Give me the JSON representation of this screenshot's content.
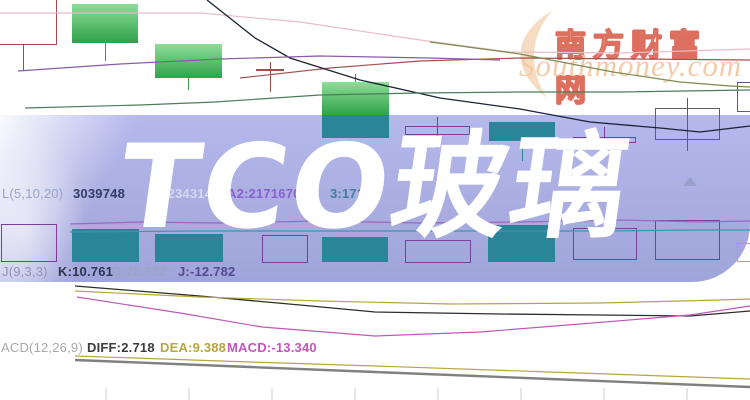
{
  "banner": {
    "title": "TCO玻璃"
  },
  "watermark": {
    "cn": "南方财富网",
    "en": "Southmoney.com"
  },
  "rows": {
    "vol": {
      "label": "L(5,10,20)",
      "value": "3039748",
      "ma1": ":234314",
      "ma2": "A2:2171670",
      "ma3": "3:171"
    },
    "kdj": {
      "label": "J(9,3,3)",
      "k": "K:10.761",
      "d": "D:22.532",
      "j": "J:-12.782"
    },
    "macd": {
      "label": "ACD(12,26,9)",
      "diff": "DIFF:2.718",
      "dea": "DEA:9.388",
      "macd": "MACD:-13.340"
    }
  },
  "colors": {
    "band": "#abafe0",
    "banner_text": "#ffffff",
    "green_candle_top": "#8edd98",
    "green_candle": "#2fa24a",
    "teal": "#2b8598",
    "maroon": "#a34a4a",
    "purple_outline": "#7a3f9a",
    "grey_outline": "#5a5f6e",
    "tan_outline": "#b3a08e",
    "watermark_red": "#dd6f5f",
    "watermark_orange": "#f4cba6",
    "vol_label": "#9aa4c8",
    "vol_value": "#323c66",
    "vol_ma1": "#d5d8f0",
    "vol_ma2": "#8a5fd0",
    "vol_ma3": "#3f7f9a",
    "kdj_label": "#8f94b8",
    "kdj_k": "#2f3550",
    "kdj_d": "#9fa4c6",
    "kdj_j": "#564a90",
    "macd_label": "#a8a8a8",
    "macd_diff": "#3c3c3c",
    "macd_dea": "#b5a642",
    "macd_macd": "#c356ba"
  },
  "chart_data": {
    "type": "candlestick",
    "title": "TCO玻璃",
    "axes_visible": false,
    "units": "screenshot pixel coordinates (no numeric axes are shown in the image)",
    "indicator_readouts": {
      "volume": 3039748,
      "vol_ma1": 234314,
      "vol_ma2": 2171670,
      "kdj": {
        "params": [
          9,
          3,
          3
        ],
        "k": 10.761,
        "d": 22.532,
        "j": -12.782
      },
      "macd": {
        "params": [
          12,
          26,
          9
        ],
        "diff": 2.718,
        "dea": 9.388,
        "macd": -13.34
      }
    },
    "wick_colors": {
      "green": "#2f9e4a",
      "teal": "#2b8598",
      "doji": "#a34a4a",
      "hollow-maroon": "#a34a4a",
      "hollow-purple": "#7a3f9a",
      "hollow-grey": "#5a5f6e",
      "hollow-tan": "#b3a08e"
    },
    "candles": [
      {
        "x": -6,
        "w": 63,
        "y": -4,
        "h": 49,
        "style": "hollow-maroon",
        "wick": {
          "x": 23,
          "y1": 45,
          "y2": 71
        }
      },
      {
        "x": 72,
        "w": 66,
        "y": 4,
        "h": 39,
        "style": "green",
        "wick": {
          "x": 105,
          "y1": 43,
          "y2": 61
        }
      },
      {
        "x": 155,
        "w": 67,
        "y": 44,
        "h": 34,
        "style": "green",
        "wick": {
          "x": 188,
          "y1": 78,
          "y2": 90
        }
      },
      {
        "x": 256,
        "w": 28,
        "y": 69,
        "h": 2,
        "style": "doji",
        "wick": {
          "x": 270,
          "y1": 62,
          "y2": 92
        }
      },
      {
        "x": 322,
        "w": 67,
        "y": 82,
        "h": 33,
        "style": "green",
        "wick": {
          "x": 355,
          "y1": 74,
          "y2": 82
        }
      },
      {
        "x": 322,
        "w": 67,
        "y": 115,
        "h": 23,
        "style": "teal"
      },
      {
        "x": 405,
        "w": 65,
        "y": 126,
        "h": 9,
        "style": "hollow-purple",
        "wick": {
          "x": 437,
          "y1": 117,
          "y2": 148
        }
      },
      {
        "x": 489,
        "w": 66,
        "y": 122,
        "h": 19,
        "style": "teal",
        "wick": {
          "x": 522,
          "y1": 141,
          "y2": 161
        }
      },
      {
        "x": 573,
        "w": 63,
        "y": 137,
        "h": 6,
        "style": "hollow-purple",
        "wick": {
          "x": 604,
          "y1": 127,
          "y2": 156
        }
      },
      {
        "x": 655,
        "w": 65,
        "y": 108,
        "h": 32,
        "style": "hollow-grey",
        "wick": {
          "x": 687,
          "y1": 98,
          "y2": 151
        }
      },
      {
        "x": 737,
        "w": 18,
        "y": 82,
        "h": 30,
        "style": "hollow-grey"
      }
    ],
    "volume_bars": [
      {
        "x": 1,
        "w": 56,
        "y": 224,
        "h": 38,
        "style": "hollow-purple"
      },
      {
        "x": 72,
        "w": 67,
        "y": 229,
        "h": 33,
        "style": "teal"
      },
      {
        "x": 155,
        "w": 68,
        "y": 234,
        "h": 28,
        "style": "teal"
      },
      {
        "x": 262,
        "w": 46,
        "y": 235,
        "h": 28,
        "style": "hollow-purple"
      },
      {
        "x": 322,
        "w": 66,
        "y": 237,
        "h": 25,
        "style": "teal"
      },
      {
        "x": 405,
        "w": 66,
        "y": 240,
        "h": 23,
        "style": "hollow-purple"
      },
      {
        "x": 488,
        "w": 67,
        "y": 225,
        "h": 37,
        "style": "teal"
      },
      {
        "x": 573,
        "w": 64,
        "y": 228,
        "h": 32,
        "style": "hollow-purple"
      },
      {
        "x": 655,
        "w": 65,
        "y": 220,
        "h": 40,
        "style": "hollow-purple"
      },
      {
        "x": 737,
        "w": 18,
        "y": 243,
        "h": 19,
        "style": "hollow-tan"
      }
    ],
    "lines": [
      {
        "name": "ma-pink",
        "color": "#e9bcc8",
        "w": 1.2,
        "pts": [
          [
            0,
            13
          ],
          [
            200,
            13
          ],
          [
            300,
            22
          ],
          [
            420,
            40
          ],
          [
            510,
            52
          ],
          [
            620,
            53
          ],
          [
            750,
            49
          ]
        ]
      },
      {
        "name": "ma-maroon",
        "color": "#a85050",
        "w": 1.2,
        "pts": [
          [
            240,
            78
          ],
          [
            330,
            68
          ],
          [
            420,
            61
          ],
          [
            520,
            58
          ],
          [
            640,
            59
          ],
          [
            750,
            60
          ]
        ]
      },
      {
        "name": "price-line",
        "color": "#1c2433",
        "w": 1.3,
        "pts": [
          [
            207,
            0
          ],
          [
            255,
            38
          ],
          [
            290,
            58
          ],
          [
            360,
            80
          ],
          [
            440,
            98
          ],
          [
            520,
            109
          ],
          [
            590,
            122
          ],
          [
            660,
            128
          ],
          [
            700,
            132
          ],
          [
            750,
            126
          ]
        ]
      },
      {
        "name": "ma-purple",
        "color": "#8a5aa8",
        "w": 1.2,
        "pts": [
          [
            18,
            71
          ],
          [
            120,
            64
          ],
          [
            220,
            59
          ],
          [
            320,
            56
          ],
          [
            430,
            58
          ],
          [
            500,
            60
          ]
        ]
      },
      {
        "name": "ma-green",
        "color": "#4d7c5c",
        "w": 1.2,
        "pts": [
          [
            25,
            108
          ],
          [
            140,
            105
          ],
          [
            215,
            102
          ],
          [
            320,
            95
          ],
          [
            420,
            93
          ],
          [
            520,
            92
          ],
          [
            620,
            92
          ],
          [
            750,
            90
          ]
        ]
      },
      {
        "name": "ma-olive",
        "color": "#7d8a50",
        "w": 1.2,
        "pts": [
          [
            430,
            42
          ],
          [
            520,
            54
          ],
          [
            613,
            72
          ],
          [
            680,
            82
          ],
          [
            730,
            86
          ],
          [
            750,
            87
          ]
        ]
      },
      {
        "name": "vol-ma-purple",
        "color": "#9a6ac0",
        "w": 1.2,
        "pts": [
          [
            70,
            224
          ],
          [
            140,
            222
          ],
          [
            220,
            223
          ],
          [
            320,
            221
          ],
          [
            420,
            223
          ],
          [
            520,
            222
          ],
          [
            620,
            220
          ],
          [
            700,
            222
          ],
          [
            750,
            221
          ]
        ]
      },
      {
        "name": "vol-ma-purple2",
        "color": "#c0a8e0",
        "w": 1.0,
        "pts": [
          [
            70,
            227
          ],
          [
            160,
            226
          ],
          [
            260,
            227
          ],
          [
            340,
            226
          ]
        ]
      },
      {
        "name": "vol-ma-teal",
        "color": "#3d96aa",
        "w": 1.2,
        "pts": [
          [
            70,
            232
          ],
          [
            200,
            231
          ],
          [
            400,
            231
          ],
          [
            600,
            231
          ],
          [
            700,
            230
          ],
          [
            750,
            230
          ]
        ]
      },
      {
        "name": "macd-diff-line",
        "color": "#2e2e2e",
        "w": 1.3,
        "pts": [
          [
            75,
            286
          ],
          [
            200,
            296
          ],
          [
            300,
            305
          ],
          [
            375,
            312
          ],
          [
            500,
            314
          ],
          [
            600,
            315
          ],
          [
            690,
            316
          ],
          [
            750,
            311
          ]
        ]
      },
      {
        "name": "macd-dea-line",
        "color": "#b5a642",
        "w": 1.2,
        "pts": [
          [
            75,
            291
          ],
          [
            200,
            297
          ],
          [
            320,
            301
          ],
          [
            450,
            304
          ],
          [
            600,
            303
          ],
          [
            720,
            300
          ],
          [
            750,
            299
          ]
        ]
      },
      {
        "name": "macd-magenta",
        "color": "#c257b8",
        "w": 1.2,
        "pts": [
          [
            77,
            297
          ],
          [
            180,
            313
          ],
          [
            262,
            327
          ],
          [
            375,
            336
          ],
          [
            480,
            332
          ],
          [
            580,
            324
          ],
          [
            690,
            315
          ],
          [
            750,
            306
          ]
        ]
      },
      {
        "name": "macd-khaki2",
        "color": "#b5a642",
        "w": 1.2,
        "pts": [
          [
            75,
            356
          ],
          [
            250,
            362
          ],
          [
            375,
            366
          ],
          [
            550,
            372
          ],
          [
            750,
            379
          ]
        ]
      },
      {
        "name": "macd-grey",
        "color": "#808080",
        "w": 2.4,
        "pts": [
          [
            75,
            360
          ],
          [
            250,
            367
          ],
          [
            375,
            372
          ],
          [
            550,
            379
          ],
          [
            750,
            387
          ]
        ]
      }
    ],
    "ticks": {
      "color": "#c9cdda",
      "y1": 388,
      "y2": 400,
      "x": [
        106,
        189,
        272,
        355,
        438,
        521,
        604,
        687
      ]
    }
  }
}
